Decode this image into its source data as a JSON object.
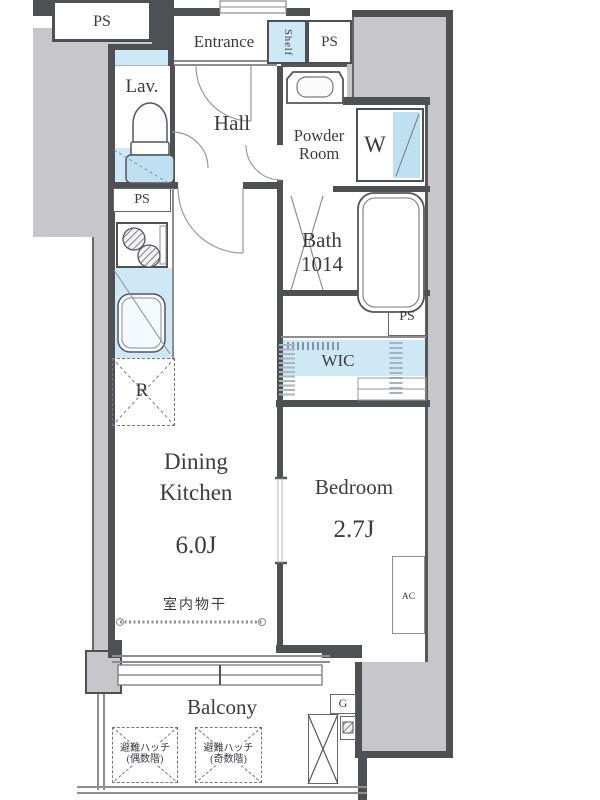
{
  "plan": {
    "type": "japanese-apartment-floor-plan",
    "labels": {
      "ps_top_left": "PS",
      "entrance": "Entrance",
      "shelf": "Shelf",
      "ps_top_right": "PS",
      "lavatory": "Lav.",
      "hall": "Hall",
      "powder_room_line1": "Powder",
      "powder_room_line2": "Room",
      "washing_machine": "W",
      "bath_line1": "Bath",
      "bath_line2": "1014",
      "ps_kitchen": "PS",
      "ps_mid_right": "PS",
      "walk_in_closet": "WIC",
      "refrigerator": "R",
      "dining_line1": "Dining",
      "dining_line2": "Kitchen",
      "dining_size": "6.0J",
      "indoor_drying": "室内物干",
      "bedroom": "Bedroom",
      "bedroom_size": "2.7J",
      "air_conditioner": "AC",
      "balcony": "Balcony",
      "hatch_even_line1": "避難ハッチ",
      "hatch_even_line2": "(偶数階)",
      "hatch_odd_line1": "避難ハッチ",
      "hatch_odd_line2": "(奇数階)",
      "gas_meter": "G"
    },
    "colors": {
      "wall": "#4f5054",
      "exterior": "#c6c6cb",
      "water": "#cfe8f5",
      "water_deep": "#bfe0f0",
      "line": "#8d8d93",
      "text": "#3b3b42"
    }
  }
}
